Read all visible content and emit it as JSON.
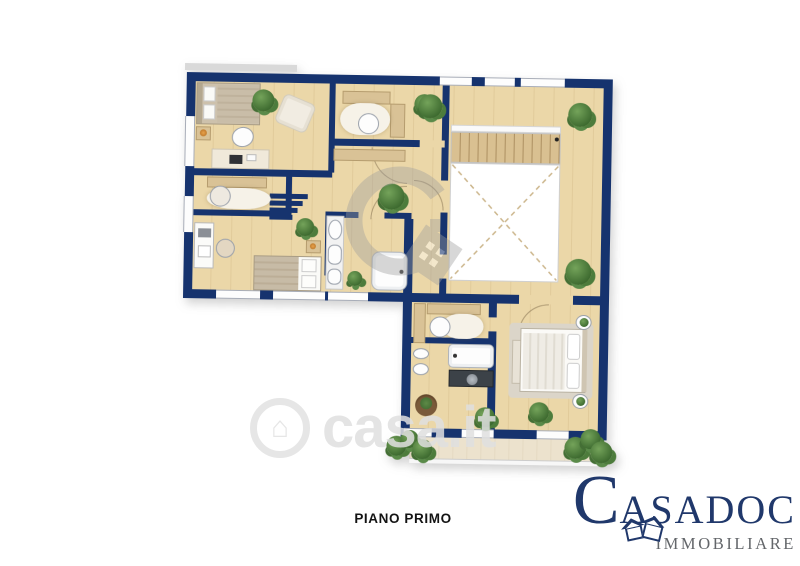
{
  "labels": {
    "floor": "PIANO PRIMO"
  },
  "watermark": {
    "text": "casa.it",
    "icon_glyph": "⌂",
    "color": "#e0e0e0"
  },
  "center_watermark": {
    "icon": "casadoc-ring-house-icon",
    "color": "#9e9e9e",
    "opacity": 0.4
  },
  "agency": {
    "initial": "C",
    "name_rest": "ASADOC",
    "subtitle": "IMMOBILIARE",
    "name_color": "#20386b",
    "subtitle_color": "#63666a",
    "icon": "twin-houses-icon"
  },
  "plan": {
    "wall_color": "#16336e",
    "floor_color": "#ebd7a8",
    "stair_color": "#d9c091",
    "terrace_color": "#ece2cd",
    "rug_color": "#f6f2e8",
    "plant_color": "#4e8040",
    "elements": [
      "single-bed",
      "double-bed",
      "desk",
      "office-chair",
      "pouf",
      "bench",
      "sideboard",
      "sink",
      "toilet",
      "bidet",
      "bathtub",
      "vanity-counter",
      "staircase",
      "open-void",
      "rug",
      "plant",
      "terrace-planter",
      "window",
      "door-arc"
    ]
  }
}
